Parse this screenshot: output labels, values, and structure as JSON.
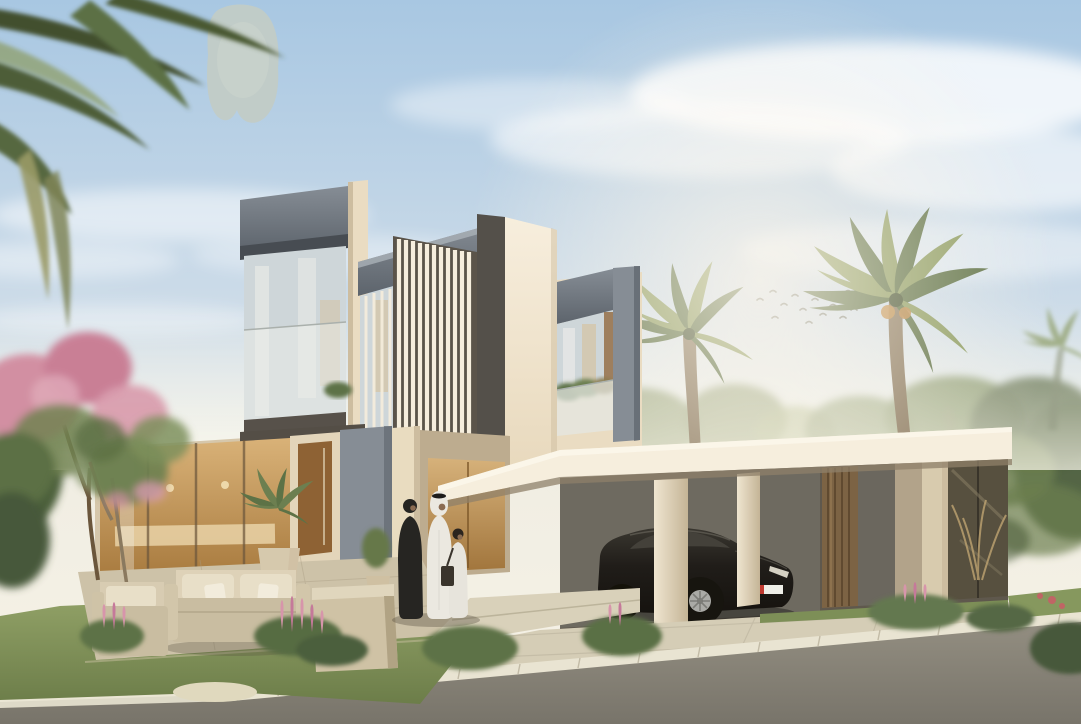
{
  "meta": {
    "title": "Modern two-storey villa exterior rendering",
    "type": "architectural visualization, no visible text",
    "width": 1081,
    "height": 724
  },
  "scene": {
    "description": "Daytime render of a contemporary cream-colored villa with vertical louvre facades and grey fascias, glass balconies with plants, a warm-lit interior, a flat-roof carport with bronze panels sheltering a black sedan with a red/white licence plate, a paved driveway meeting an asphalt road with a stone curb, a front garden with pink flowering shrubs and an outdoor beige lounge set, three figures in traditional Emirati dress near the entrance, palm trees left and right, a flock of birds, soft clouds, and a grey inpainting-artifact blob in the sky.",
    "objects": [
      "sky with clouds",
      "grey artifact blob",
      "bird flock",
      "background trees",
      "overhanging palm fronds top-left",
      "tall royal palm",
      "bushy palm by entrance",
      "left louvred facade panel",
      "upper glass balcony",
      "lower warm-lit window wall",
      "wood pivot entry door",
      "central louvre screen tower",
      "bright blank wall",
      "right wing with planted balcony",
      "entrance canopy",
      "carport with bronze panels",
      "black electric sedan",
      "licence plate red/white",
      "cream columns",
      "paved driveway",
      "asphalt road",
      "white stone curb",
      "lawn and shrubs",
      "pink flower spikes",
      "flowering tree",
      "outdoor sofa and armchairs",
      "potted palm planter",
      "woman in black abaya",
      "man in white kandura and ghutra",
      "child in white with dark shoulder bag"
    ]
  },
  "palette": {
    "skyTop": "#a8c7e2",
    "skyMid": "#cfdde9",
    "skyHorizon": "#f1eee3",
    "cloudWhite": "#ffffff",
    "sunGlow": "#fff7ea",
    "blobGray": "#c2ccc5",
    "birdDark": "#6a6d60",
    "treeGreen": "#6c7f50",
    "treeDark": "#4c5e3b",
    "treeLight": "#8a9a62",
    "palmGreen": "#5c7045",
    "palmLight": "#8a9a5f",
    "palmDark": "#42502f",
    "palmDry": "#9a9a66",
    "trunkBrown": "#8a795f",
    "trunkDark": "#6b563c",
    "wallBright": "#f6eedd",
    "wallCream": "#eadcc2",
    "wallShade": "#cdbda0",
    "wallDark": "#b9a98c",
    "louverGroove": "#b09e82",
    "screenDark": "#5b544a",
    "fasciaLight": "#aab1b8",
    "fasciaMid": "#868d95",
    "fasciaDark": "#5d646c",
    "headerDark": "#474c52",
    "glassCool": "#ced6d9",
    "glassWarm": "#d8bb8e",
    "curtainWhite": "#f2f1ec",
    "interiorAmber": "#c98f4d",
    "interiorDeep": "#9e6f33",
    "woodDoor": "#8e6234",
    "bronzePanel": "#7c6344",
    "bronzeDark": "#5a452c",
    "bronzeLight": "#a1835a",
    "panelTaupe": "#b2a38a",
    "carportInner": "#5f584d",
    "carportWall": "#6e6a60",
    "darkGlass": "#57503f",
    "roofUnderside": "#8f8069",
    "dryPlant": "#b99f6f",
    "carBody": "#201d19",
    "carGlass": "#44413a",
    "rimSilver": "#aaaaa6",
    "plateRed": "#c03a30",
    "plateWhite": "#efefe8",
    "drivewayLight": "#d5cdb6",
    "drivewayJoint": "#b9b19c",
    "roadGray": "#8f8a7d",
    "roadDark": "#78746a",
    "curbStone": "#e9e4d2",
    "patioStone": "#cdc2a8",
    "patioJoint": "#a89c82",
    "pebble": "#e0d9be",
    "grassGreen": "#8a9b63",
    "grassDark": "#6c7d49",
    "bushGreen": "#5d7246",
    "bushDark": "#46583a",
    "flowerPink": "#d795ab",
    "flowerDeep": "#c5799a",
    "blossomPink": "#d28fa2",
    "redFlower": "#c06565",
    "sofaBeige": "#c9bda1",
    "cushionCream": "#e8dfc8",
    "pillowWhite": "#f2ecdc",
    "abayaBlack": "#262522",
    "kanduraWhite": "#ebe8e0",
    "skinTan": "#8a6b52",
    "bagDark": "#3a342c"
  }
}
